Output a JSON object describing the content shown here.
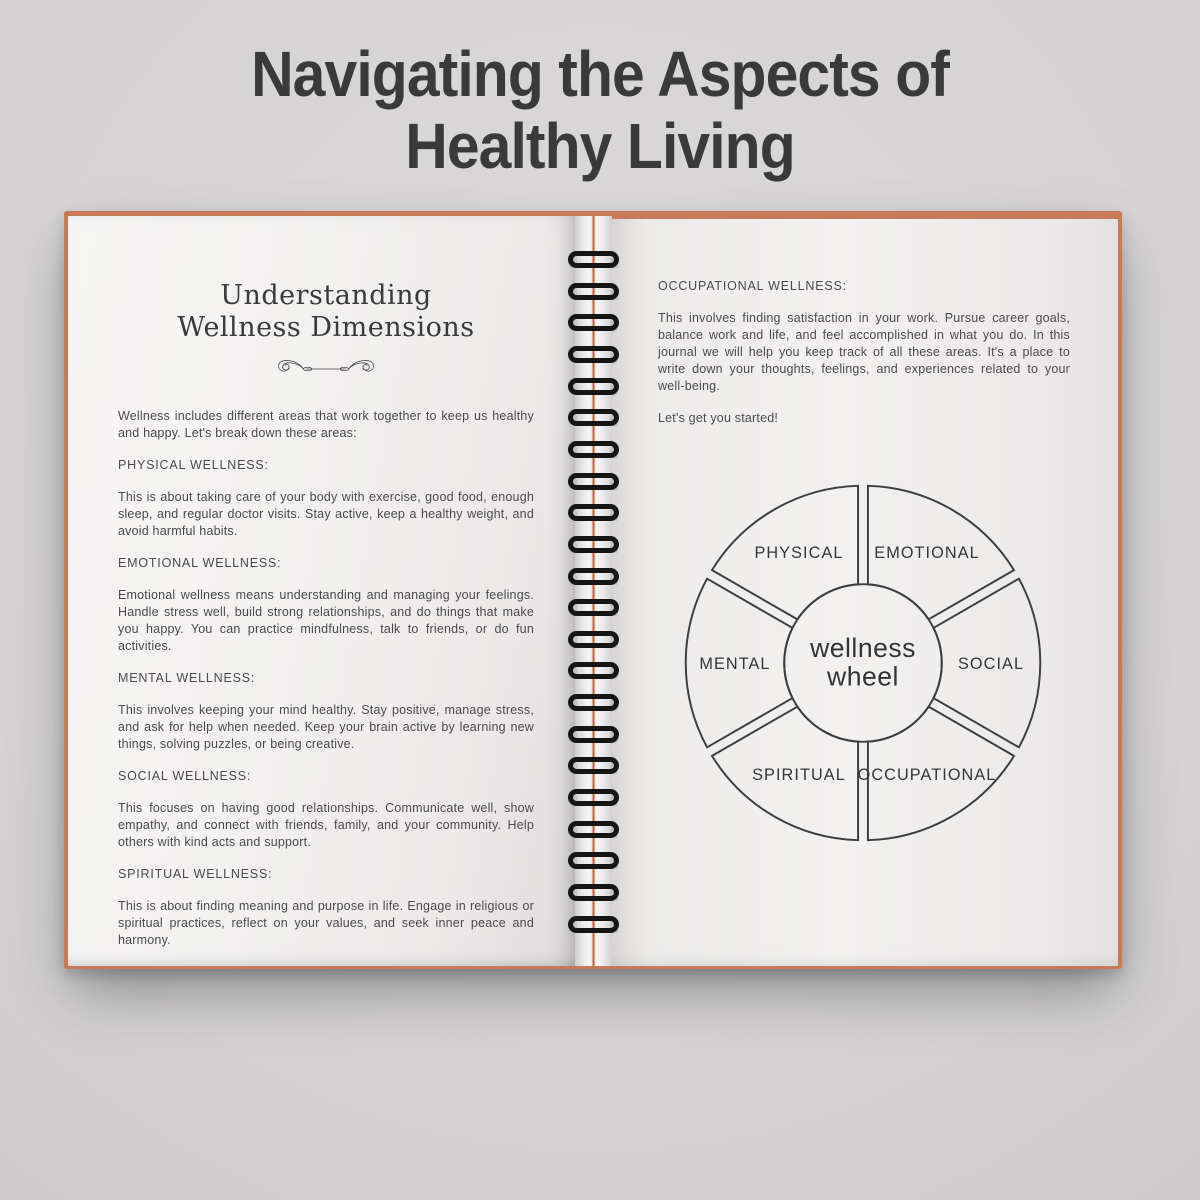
{
  "title": {
    "line1": "Navigating the Aspects of",
    "line2": "Healthy Living"
  },
  "left_page": {
    "heading": {
      "line1": "Understanding",
      "line2": "Wellness Dimensions"
    },
    "divider_icon": "flourish-heart-arrow",
    "intro": "Wellness includes different areas that work together to keep us healthy and happy. Let's break down these areas:",
    "sections": [
      {
        "heading": "PHYSICAL WELLNESS:",
        "body": "This is about taking care of your body with exercise, good food, enough sleep, and regular doctor visits. Stay active, keep a healthy weight, and avoid harmful habits."
      },
      {
        "heading": "EMOTIONAL WELLNESS:",
        "body": "Emotional wellness means understanding and managing your feelings. Handle stress well, build strong relationships, and do things that make you happy. You can practice mindfulness, talk to friends, or do fun activities."
      },
      {
        "heading": "MENTAL WELLNESS:",
        "body": "This involves keeping your mind healthy. Stay positive, manage stress, and ask for help when needed. Keep your brain active by learning new things, solving puzzles, or being creative."
      },
      {
        "heading": "SOCIAL WELLNESS:",
        "body": "This focuses on having good relationships. Communicate well, show empathy, and connect with friends, family, and your community. Help others with kind acts and support."
      },
      {
        "heading": "SPIRITUAL WELLNESS:",
        "body": "This is about finding meaning and purpose in life. Engage in religious or spiritual practices, reflect on your values, and seek inner peace and harmony."
      }
    ]
  },
  "right_page": {
    "sections": [
      {
        "heading": "OCCUPATIONAL WELLNESS:",
        "body": "This involves finding satisfaction in your work. Pursue career goals, balance work and life, and feel accomplished in what you do. In this journal we will help you keep track of all these areas. It's a place to write down your thoughts, feelings, and experiences related to your well-being."
      }
    ],
    "cta": "Let's get you started!",
    "wellness_wheel": {
      "center_line1": "wellness",
      "center_line2": "wheel",
      "segments": [
        {
          "label": "PHYSICAL",
          "mid_angle": 120
        },
        {
          "label": "EMOTIONAL",
          "mid_angle": 60
        },
        {
          "label": "SOCIAL",
          "mid_angle": 0
        },
        {
          "label": "OCCUPATIONAL",
          "mid_angle": 300
        },
        {
          "label": "SPIRITUAL",
          "mid_angle": 240
        },
        {
          "label": "MENTAL",
          "mid_angle": 180
        }
      ]
    }
  },
  "notebook": {
    "ring_count": 22,
    "cover_color": "#c87957",
    "spine_line_color": "#bf6b49"
  },
  "colors": {
    "background": "#d6d4d5",
    "title_ink": "#3b3a3a",
    "page_ink": "#4c4a4b",
    "wheel_stroke": "#3f3e3e"
  }
}
